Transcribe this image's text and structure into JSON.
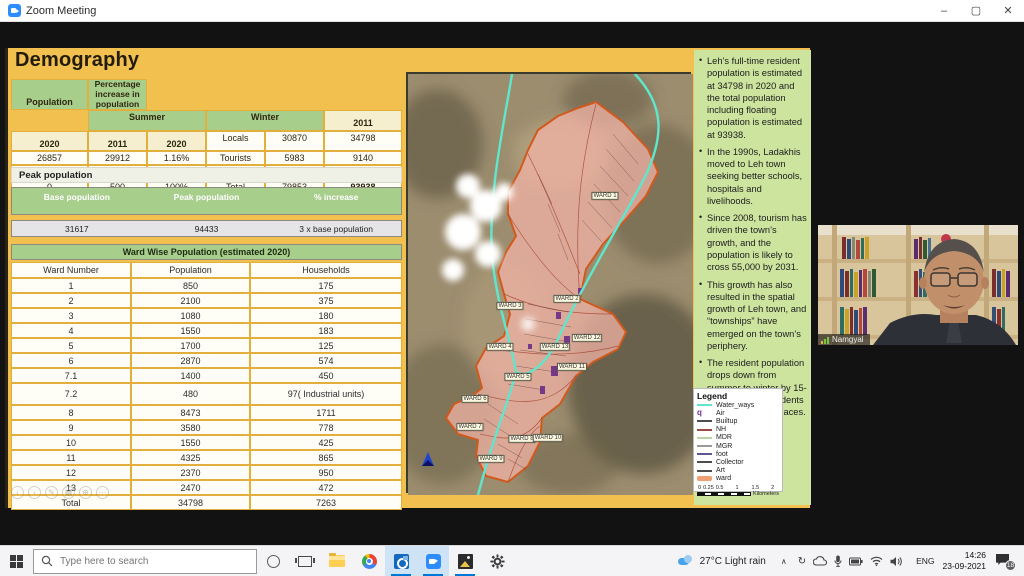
{
  "window": {
    "title": "Zoom Meeting",
    "controls": {
      "minimize": "–",
      "maximize": "▢",
      "close": "✕"
    }
  },
  "slide": {
    "title": "Demography",
    "demography_table": {
      "row_header": "Population",
      "group_summer": "Summer",
      "group_winter": "Winter",
      "pct_header": "Percentage increase in population",
      "years": [
        "2011",
        "2020",
        "2011",
        "2020"
      ],
      "rows": [
        {
          "label": "Locals",
          "s11": "30870",
          "s20": "34798",
          "w11": "26857",
          "w20": "29912",
          "pct": "1.16%"
        },
        {
          "label": "Tourists",
          "s11": "5983",
          "s20": "9140",
          "w11": "0",
          "w20": "300",
          "pct": "30.4%"
        },
        {
          "label": "Migrants",
          "s11": "43000",
          "s20": "50000",
          "w11": "0",
          "w20": "500",
          "pct": "100%"
        },
        {
          "label": "Total",
          "s11": "79853",
          "s20": "93938",
          "w11": "26857",
          "w20": "30712",
          "pct": "3%"
        }
      ]
    },
    "peak": {
      "title": "Peak population",
      "headers": [
        "Base population",
        "Peak population",
        "% increase"
      ],
      "row": [
        "31617",
        "94433",
        "3 x base population"
      ]
    },
    "ward_table": {
      "title": "Ward Wise Population (estimated 2020)",
      "headers": [
        "Ward Number",
        "Population",
        "Households"
      ],
      "rows": [
        [
          "1",
          "850",
          "175"
        ],
        [
          "2",
          "2100",
          "375"
        ],
        [
          "3",
          "1080",
          "180"
        ],
        [
          "4",
          "1550",
          "183"
        ],
        [
          "5",
          "1700",
          "125"
        ],
        [
          "6",
          "2870",
          "574"
        ],
        [
          "7.1",
          "1400",
          "450"
        ],
        [
          "7.2",
          "480",
          "97( Industrial units)"
        ],
        [
          "8",
          "8473",
          "1711"
        ],
        [
          "9",
          "3580",
          "778"
        ],
        [
          "10",
          "1550",
          "425"
        ],
        [
          "11",
          "4325",
          "865"
        ],
        [
          "12",
          "2370",
          "950"
        ],
        [
          "13",
          "2470",
          "472"
        ],
        [
          "Total",
          "34798",
          "7263"
        ]
      ]
    },
    "bullets": [
      "Leh’s full-time resident population is estimated at 34798 in 2020 and the total population including floating population is estimated at 93938.",
      "In the 1990s, Ladakhis moved to Leh town seeking better schools, hospitals and livelihoods.",
      "Since 2008, tourism has driven the town’s growth, and the population is likely to cross 55,000 by 2031.",
      "This growth has also resulted in the spatial growth of Leh town, and “townships” have emerged on the town’s periphery.",
      "The resident population drops down from summer to winter by 15-20% as many residents travel to warmer places."
    ],
    "map": {
      "wards": [
        {
          "label": "WARD 1",
          "x": 197,
          "y": 122
        },
        {
          "label": "WARD 2",
          "x": 159,
          "y": 225
        },
        {
          "label": "WARD 3",
          "x": 102,
          "y": 232
        },
        {
          "label": "WARD 4",
          "x": 92,
          "y": 273
        },
        {
          "label": "WARD 13",
          "x": 147,
          "y": 273
        },
        {
          "label": "WARD 12",
          "x": 179,
          "y": 264
        },
        {
          "label": "WARD 11",
          "x": 164,
          "y": 293
        },
        {
          "label": "WARD 5",
          "x": 110,
          "y": 303
        },
        {
          "label": "WARD 6",
          "x": 67,
          "y": 325
        },
        {
          "label": "WARD 7",
          "x": 62,
          "y": 353
        },
        {
          "label": "WARD 8",
          "x": 114,
          "y": 365
        },
        {
          "label": "WARD 10",
          "x": 140,
          "y": 364
        },
        {
          "label": "WARD 9",
          "x": 83,
          "y": 385
        }
      ],
      "legend": {
        "title": "Legend",
        "items": [
          {
            "label": "Water_ways",
            "color": "#5FE6CC",
            "type": "line"
          },
          {
            "label": "Air",
            "color": "#7030A0",
            "type": "glyph",
            "glyph": "q"
          },
          {
            "label": "Builtup",
            "color": "#4D4D4D",
            "type": "line"
          },
          {
            "label": "NH",
            "color": "#9C4A44",
            "type": "line"
          },
          {
            "label": "MDR",
            "color": "#B9D6A7",
            "type": "line"
          },
          {
            "label": "MGR",
            "color": "#9A9A9A",
            "type": "line"
          },
          {
            "label": "foot",
            "color": "#5A5A8C",
            "type": "line"
          },
          {
            "label": "Collector",
            "color": "#4D4D4D",
            "type": "line"
          },
          {
            "label": "Art",
            "color": "#4D4D4D",
            "type": "line"
          },
          {
            "label": "ward",
            "color": "#F0A070",
            "type": "band"
          }
        ],
        "scale_ticks": [
          "0",
          "0.25",
          "0.5",
          "1",
          "1.5",
          "2"
        ],
        "scale_unit": "Kilometers"
      }
    },
    "pres_controls": [
      {
        "name": "previous",
        "glyph": "‹"
      },
      {
        "name": "next",
        "glyph": "›"
      },
      {
        "name": "pen",
        "glyph": "✎"
      },
      {
        "name": "slides-grid",
        "glyph": "▦"
      },
      {
        "name": "zoom-slide",
        "glyph": "⊕"
      },
      {
        "name": "more",
        "glyph": "⋯"
      }
    ]
  },
  "webcam": {
    "name": "Namgyal"
  },
  "taskbar": {
    "search_placeholder": "Type here to search",
    "weather": "27°C Light rain",
    "hidden_icons_caret": "∧",
    "language": "ENG",
    "time": "14:26",
    "date": "23-09-2021",
    "notification_count": "18"
  }
}
